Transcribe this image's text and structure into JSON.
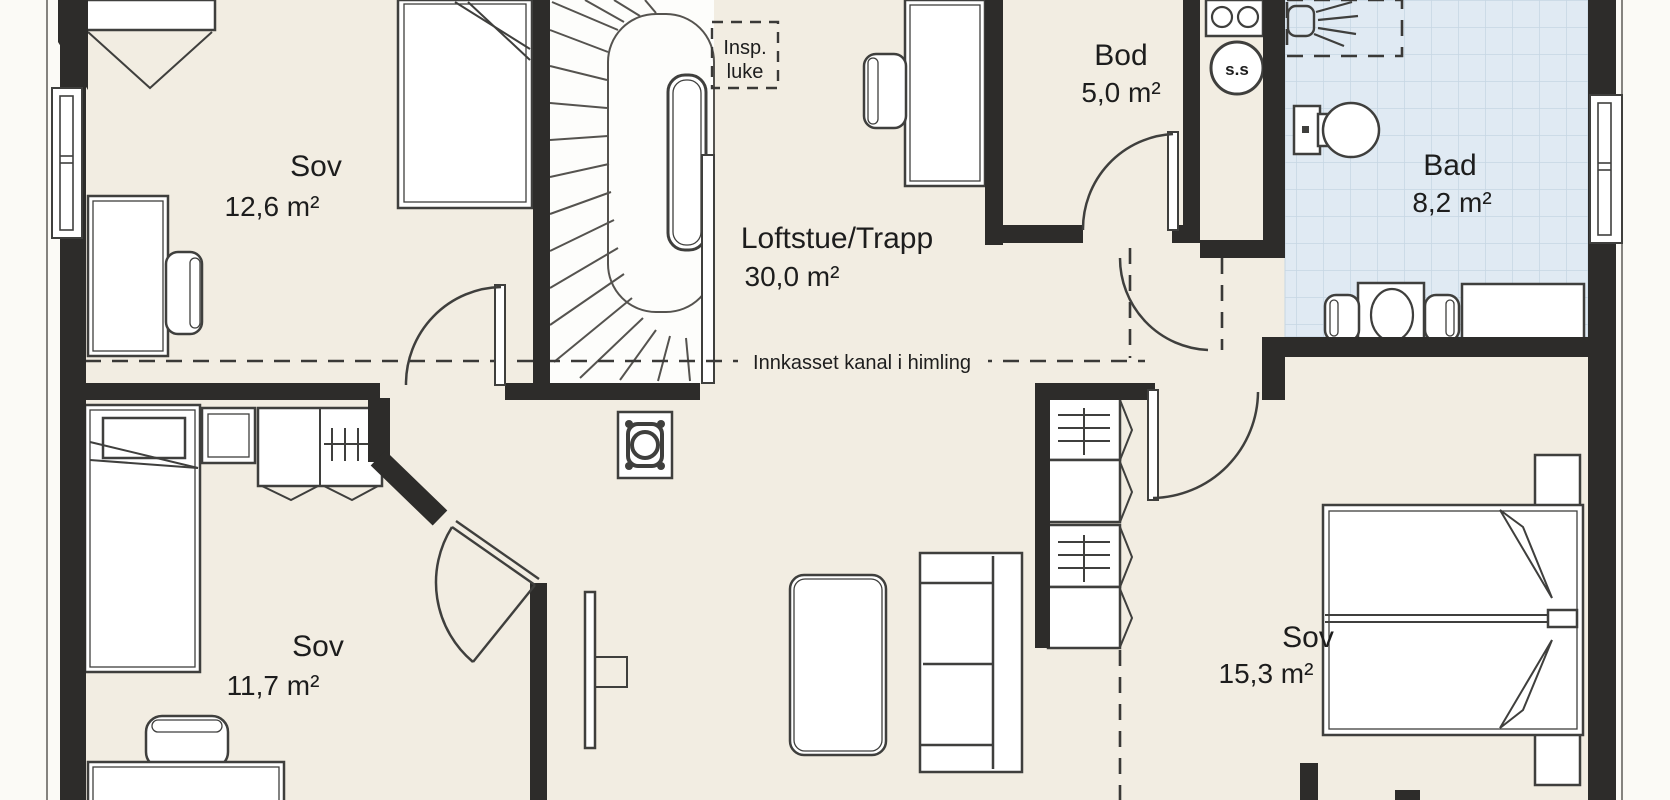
{
  "colors": {
    "bg": "#fbfaf6",
    "floor": "#f2ede2",
    "wall": "#2d2c2a",
    "tile": "#e0eaf3",
    "tile_line": "#c6d6e3",
    "line": "#3f3f3d",
    "text": "#1d1d1d"
  },
  "rooms": [
    {
      "name": "Sov",
      "area": "12,6 m²"
    },
    {
      "name": "Loftstue/Trapp",
      "area": "30,0 m²"
    },
    {
      "name": "Bod",
      "area": "5,0 m²"
    },
    {
      "name": "Bad",
      "area": "8,2 m²"
    },
    {
      "name": "Sov",
      "area": "11,7 m²"
    },
    {
      "name": "Sov",
      "area": "15,3 m²"
    }
  ],
  "annotations": {
    "inspection_hatch_line1": "Insp.",
    "inspection_hatch_line2": "luke",
    "duct_note": "Innkasset kanal i himling",
    "floor_drain_symbol": "s.s"
  }
}
